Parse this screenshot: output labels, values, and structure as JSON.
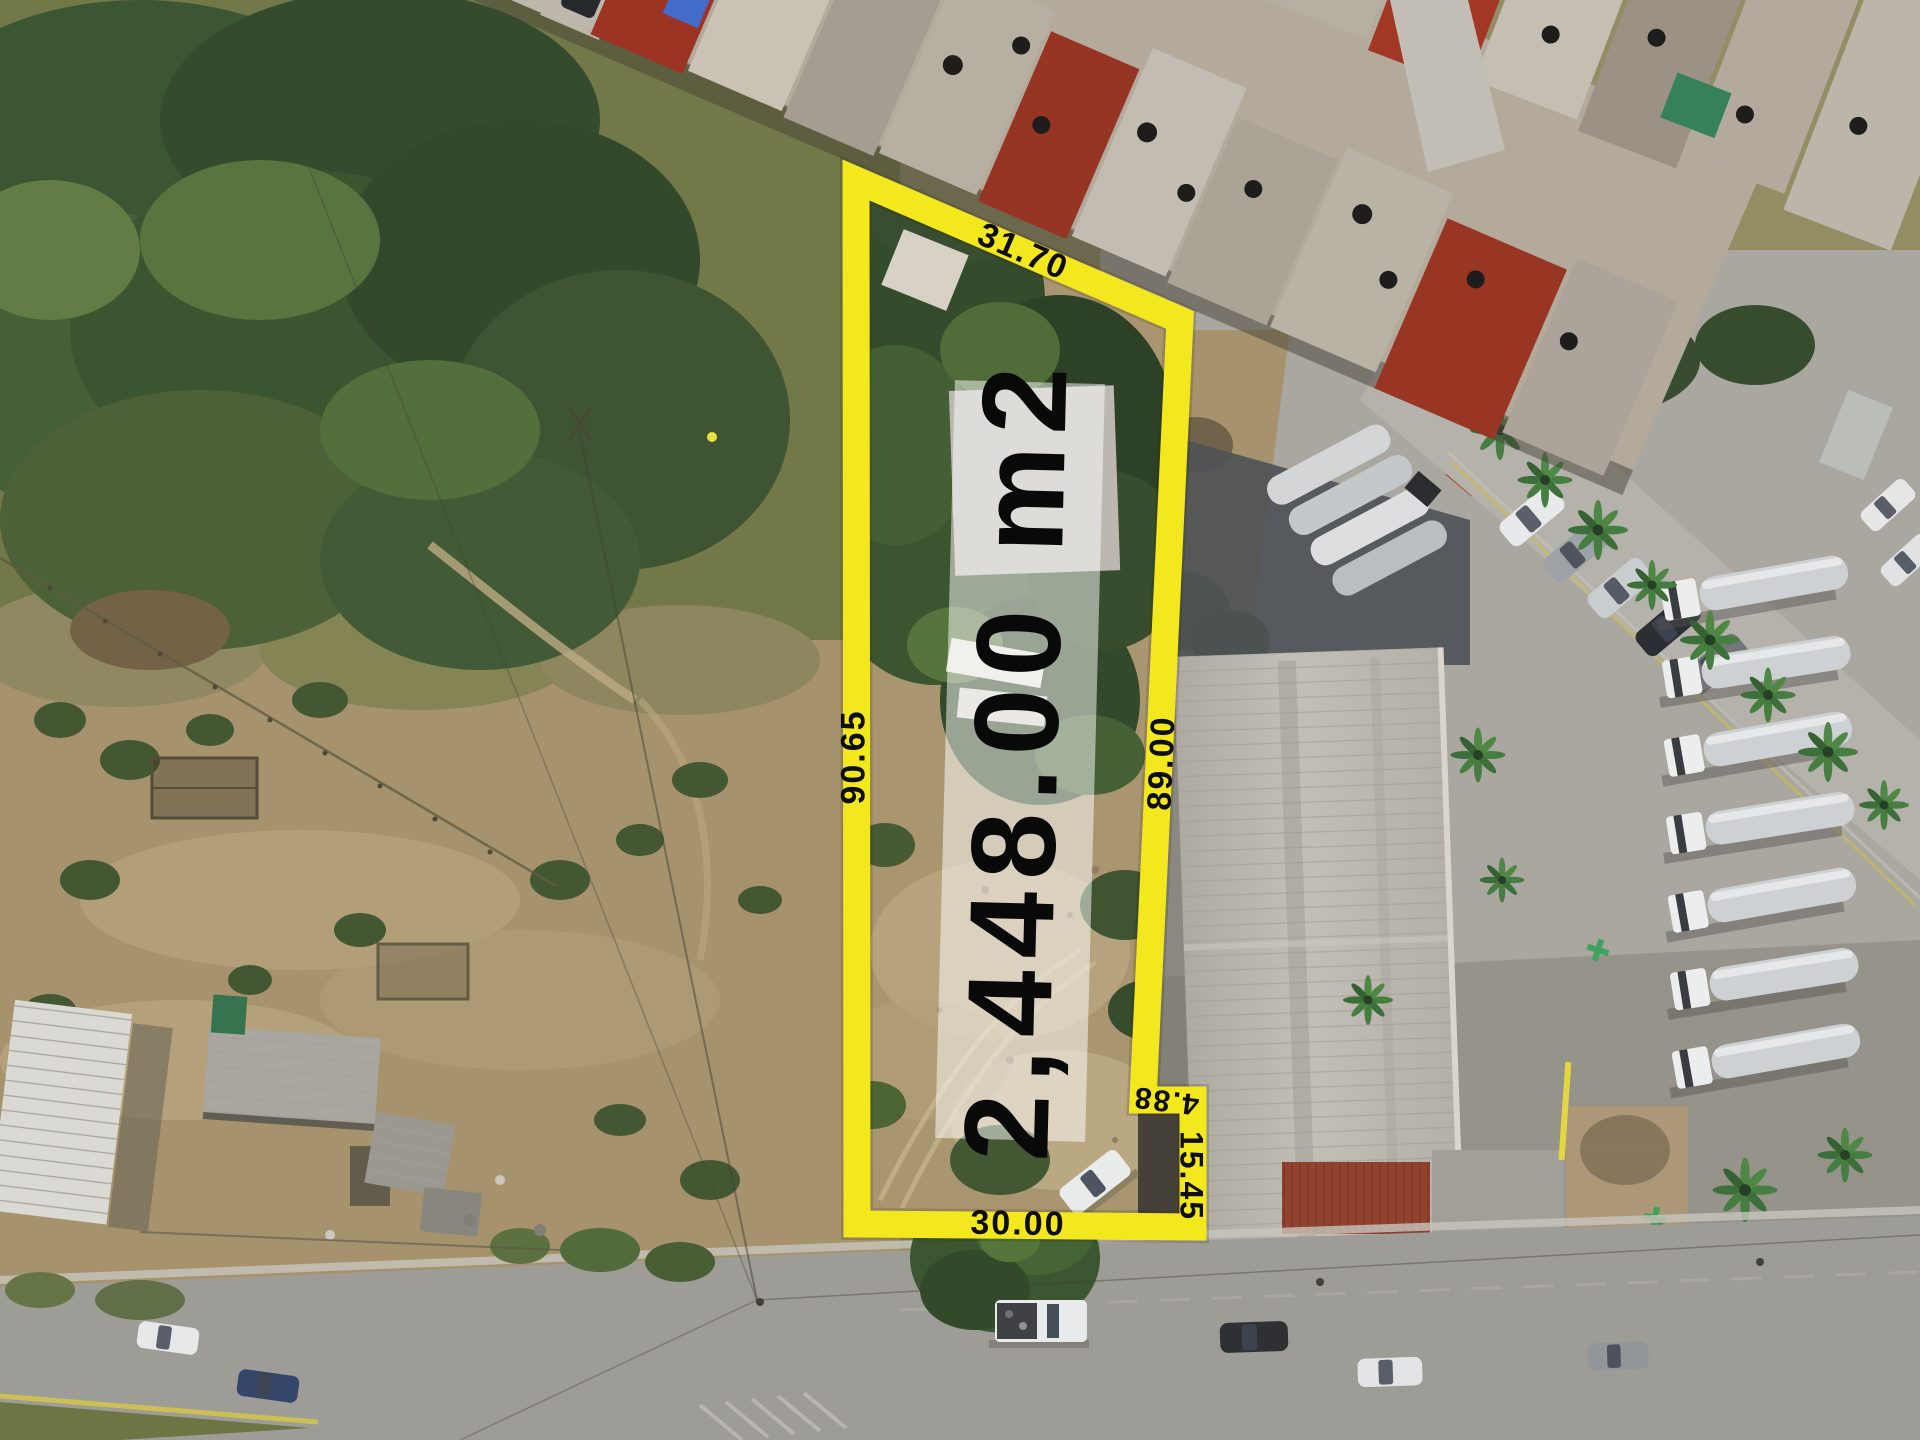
{
  "annotations": {
    "area_label": "2,448.00 m2",
    "measurements": [
      {
        "side": "top",
        "value": "31.70"
      },
      {
        "side": "left",
        "value": "90.65"
      },
      {
        "side": "right",
        "value": "89.00"
      },
      {
        "side": "notch-east",
        "value": "4.88"
      },
      {
        "side": "notch-south",
        "value": "15.45"
      },
      {
        "side": "bottom",
        "value": "30.00"
      }
    ],
    "colors": {
      "boundary": "#F3E71E",
      "labels": "#0D0D0D",
      "area_band": "rgba(255,255,255,0.5)"
    }
  }
}
